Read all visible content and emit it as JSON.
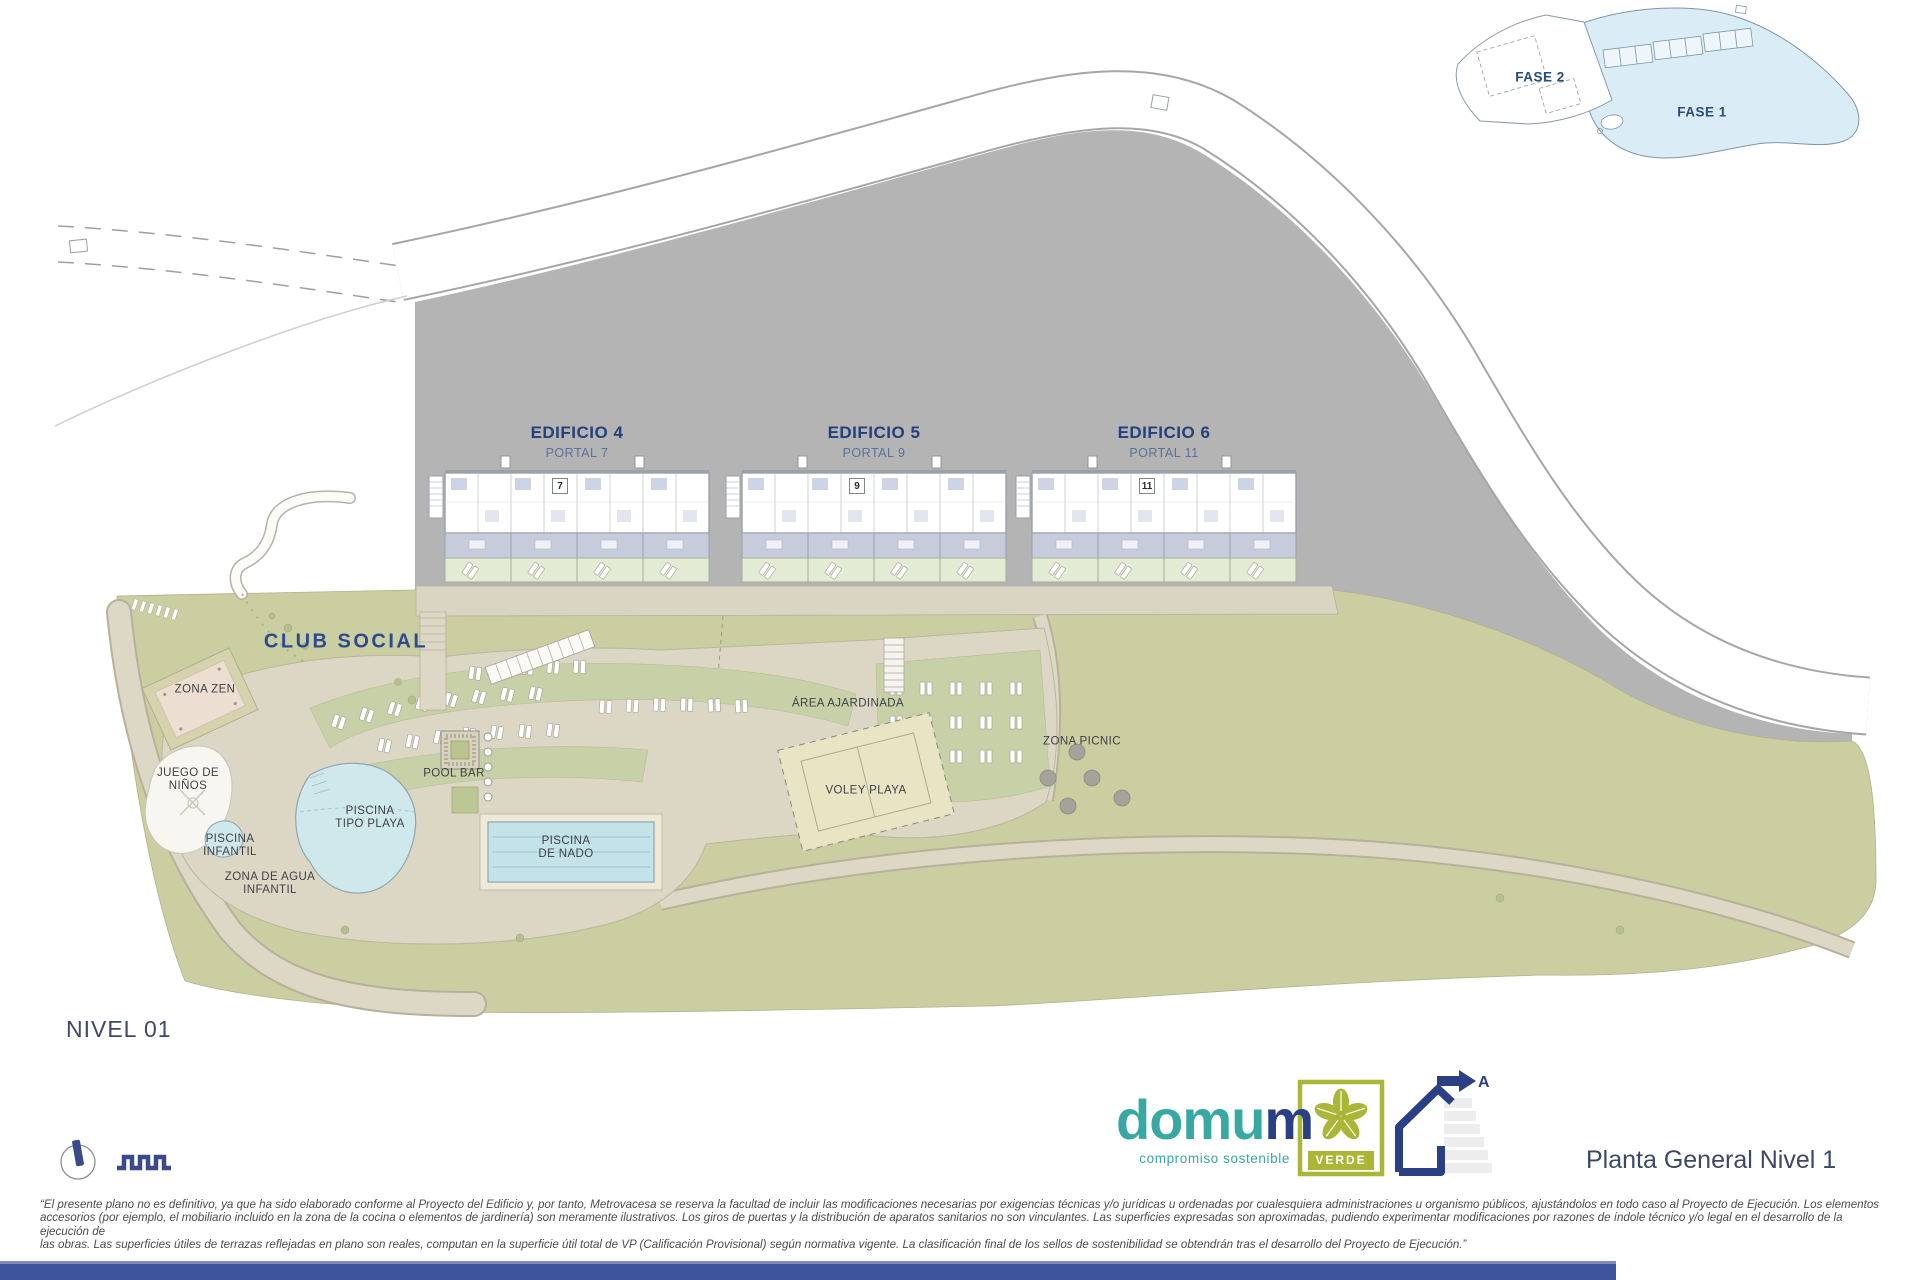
{
  "plan": {
    "level_label": "NIVEL 01",
    "buildings": [
      {
        "name": "EDIFICIO 4",
        "portal": "PORTAL 7",
        "number": "7"
      },
      {
        "name": "EDIFICIO 5",
        "portal": "PORTAL 9",
        "number": "9"
      },
      {
        "name": "EDIFICIO 6",
        "portal": "PORTAL 11",
        "number": "11"
      }
    ],
    "areas": {
      "club_social": "CLUB SOCIAL",
      "zona_zen": "ZONA ZEN",
      "juego_l1": "JUEGO DE",
      "juego_l2": "NIÑOS",
      "piscina_infantil_l1": "PISCINA",
      "piscina_infantil_l2": "INFANTIL",
      "zona_agua_l1": "ZONA DE AGUA",
      "zona_agua_l2": "INFANTIL",
      "piscina_playa_l1": "PISCINA",
      "piscina_playa_l2": "TIPO PLAYA",
      "pool_bar": "POOL BAR",
      "piscina_nado_l1": "PISCINA",
      "piscina_nado_l2": "DE NADO",
      "area_ajardinada": "ÁREA AJARDINADA",
      "voley_playa": "VOLEY PLAYA",
      "zona_picnic": "ZONA PICNIC"
    },
    "inset": {
      "fase1": "FASE 1",
      "fase2": "FASE 2"
    }
  },
  "footer": {
    "logo": {
      "brand_part1": "domu",
      "brand_part2": "m",
      "tagline": "compromiso sostenible"
    },
    "verde_badge": "VERDE",
    "energy_rating": "A",
    "plan_title": "Planta General Nivel 1",
    "disclaimer": {
      "line1": "“El presente plano no es definitivo, ya que ha sido elaborado conforme al Proyecto del Edificio y, por tanto, Metrovacesa se reserva la facultad de incluir las modificaciones necesarias por exigencias técnicas y/o jurídicas u ordenadas por cualesquiera administraciones u organismo públicos, ajustándolos en todo caso al Proyecto de Ejecución. Los elementos",
      "line2": "accesorios (por ejemplo, el mobiliario incluido en la zona de la cocina o elementos de jardinería) son meramente ilustrativos. Los giros de puertas y la distribución de aparatos sanitarios no son vinculantes. Las superficies expresadas son aproximadas, pudiendo experimentar modificaciones por razones de índole técnico y/o legal en el desarrollo de la ejecución de",
      "line3": "las obras. Las superficies útiles de terrazas reflejadas en plano son reales, computan en la superficie útil total de VP (Calificación Provisional) según normativa vigente. La clasificación final de los sellos de sostenibilidad se obtendrán tras el desarrollo del Proyecto de Ejecución.”"
    }
  },
  "colors": {
    "accent_navy": "#2B3F85",
    "brand_teal": "#38A8A3",
    "verde_green": "#A9B636",
    "plan_label_navy": "#24407B",
    "terrain_gray": "#B4B4B4",
    "landscape_green": "#CBCEA0",
    "lawn_green": "#C7D0A6",
    "pool_blue": "#CFE8EC",
    "footer_bar_blue": "#3E549C"
  }
}
